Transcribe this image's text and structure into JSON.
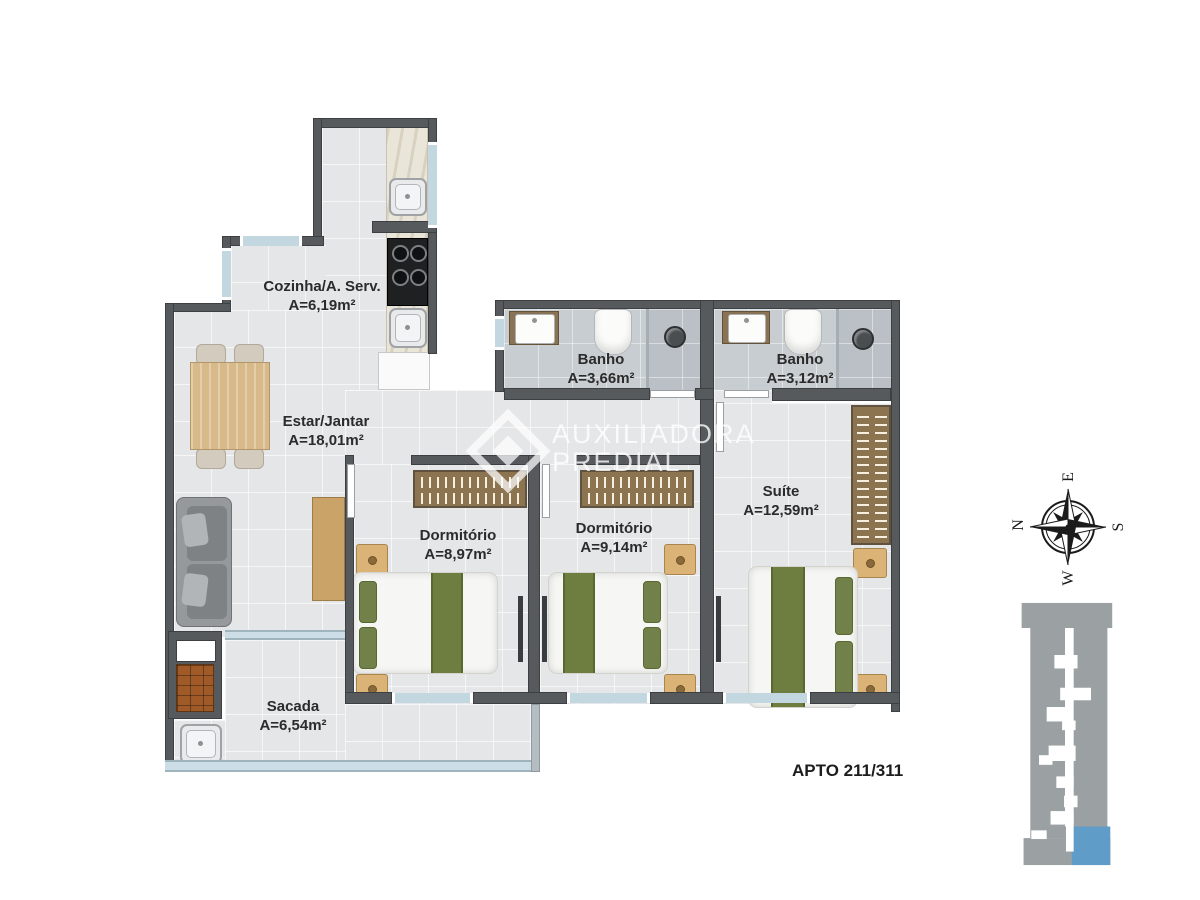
{
  "rooms": [
    {
      "id": "cozinha",
      "name": "Cozinha/A. Serv.",
      "area": "A=6,19m²"
    },
    {
      "id": "estar",
      "name": "Estar/Jantar",
      "area": "A=18,01m²"
    },
    {
      "id": "banho1",
      "name": "Banho",
      "area": "A=3,66m²"
    },
    {
      "id": "banho2",
      "name": "Banho",
      "area": "A=3,12m²"
    },
    {
      "id": "dormitorio1",
      "name": "Dormitório",
      "area": "A=8,97m²"
    },
    {
      "id": "dormitorio2",
      "name": "Dormitório",
      "area": "A=9,14m²"
    },
    {
      "id": "suite",
      "name": "Suíte",
      "area": "A=12,59m²"
    },
    {
      "id": "sacada",
      "name": "Sacada",
      "area": "A=6,54m²"
    }
  ],
  "apartment_label": "APTO 211/311",
  "watermark": {
    "line1": "AUXILIADORA",
    "line2": "PREDIAL"
  },
  "compass": {
    "n": "N",
    "e": "E",
    "s": "S",
    "w": "W"
  },
  "colors": {
    "wall": "#565a5d",
    "floor": "#e4e6e8",
    "bathroom_floor": "#c8cdd1",
    "window_glass": "#c3d7e0",
    "bed_green": "#6e7e41",
    "wood": "#d8ba8a",
    "wardrobe_brown": "#8d7451",
    "building_gray": "#9ba0a3",
    "unit_highlight_blue": "#5f9dc8",
    "label_text": "#2b2b2b"
  },
  "furniture_icons": [
    "dining-table",
    "chair",
    "sofa",
    "sideboard",
    "double-bed",
    "wardrobe",
    "nightstand",
    "tv-panel",
    "toilet",
    "washbasin",
    "shower-head",
    "cooktop",
    "kitchen-sink",
    "laundry-tank",
    "cabinet",
    "barbecue-grill",
    "balcony-sink"
  ]
}
